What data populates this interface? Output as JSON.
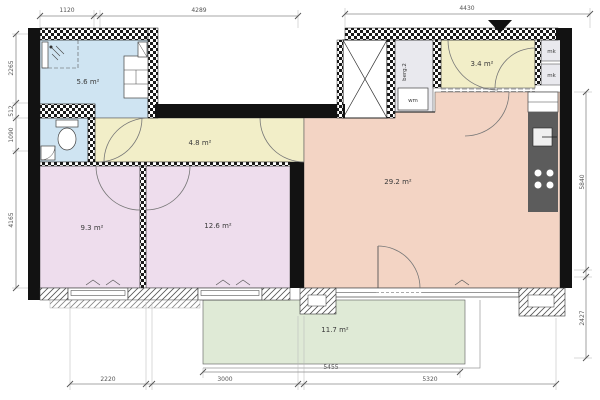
{
  "plan": {
    "rooms": {
      "bathroom": {
        "area": "5.6 m²"
      },
      "hall": {
        "area": "4.8 m²"
      },
      "entrance_hall": {
        "area": "3.4 m²"
      },
      "bedroom_left": {
        "area": "9.3 m²"
      },
      "bedroom_right": {
        "area": "12.6 m²"
      },
      "living_kitchen": {
        "area": "29.2 m²"
      },
      "terrace": {
        "area": "11.7 m²"
      },
      "storage": {
        "label": "berg.2"
      },
      "washing_machine": {
        "label": "wm"
      },
      "meter_cupboard_top": {
        "label": "mk"
      },
      "meter_cupboard_bottom": {
        "label": "mk"
      }
    },
    "dimensions_mm": {
      "top": [
        "1120",
        "4289",
        "4430"
      ],
      "left": [
        "2265",
        "512",
        "1090",
        "4165"
      ],
      "right": [
        "5840",
        "2427"
      ],
      "bottom": [
        "2220",
        "3000",
        "5455",
        "5320"
      ]
    },
    "colors": {
      "wet_room": "#cfe4f2",
      "hallway": "#f2eec8",
      "bedroom": "#eedded",
      "living": "#f3d4c4",
      "terrace": "#dfead6",
      "storage": "#e9e9ee",
      "kitchen_counter": "#5c5c5c",
      "wall": "#121212"
    }
  }
}
